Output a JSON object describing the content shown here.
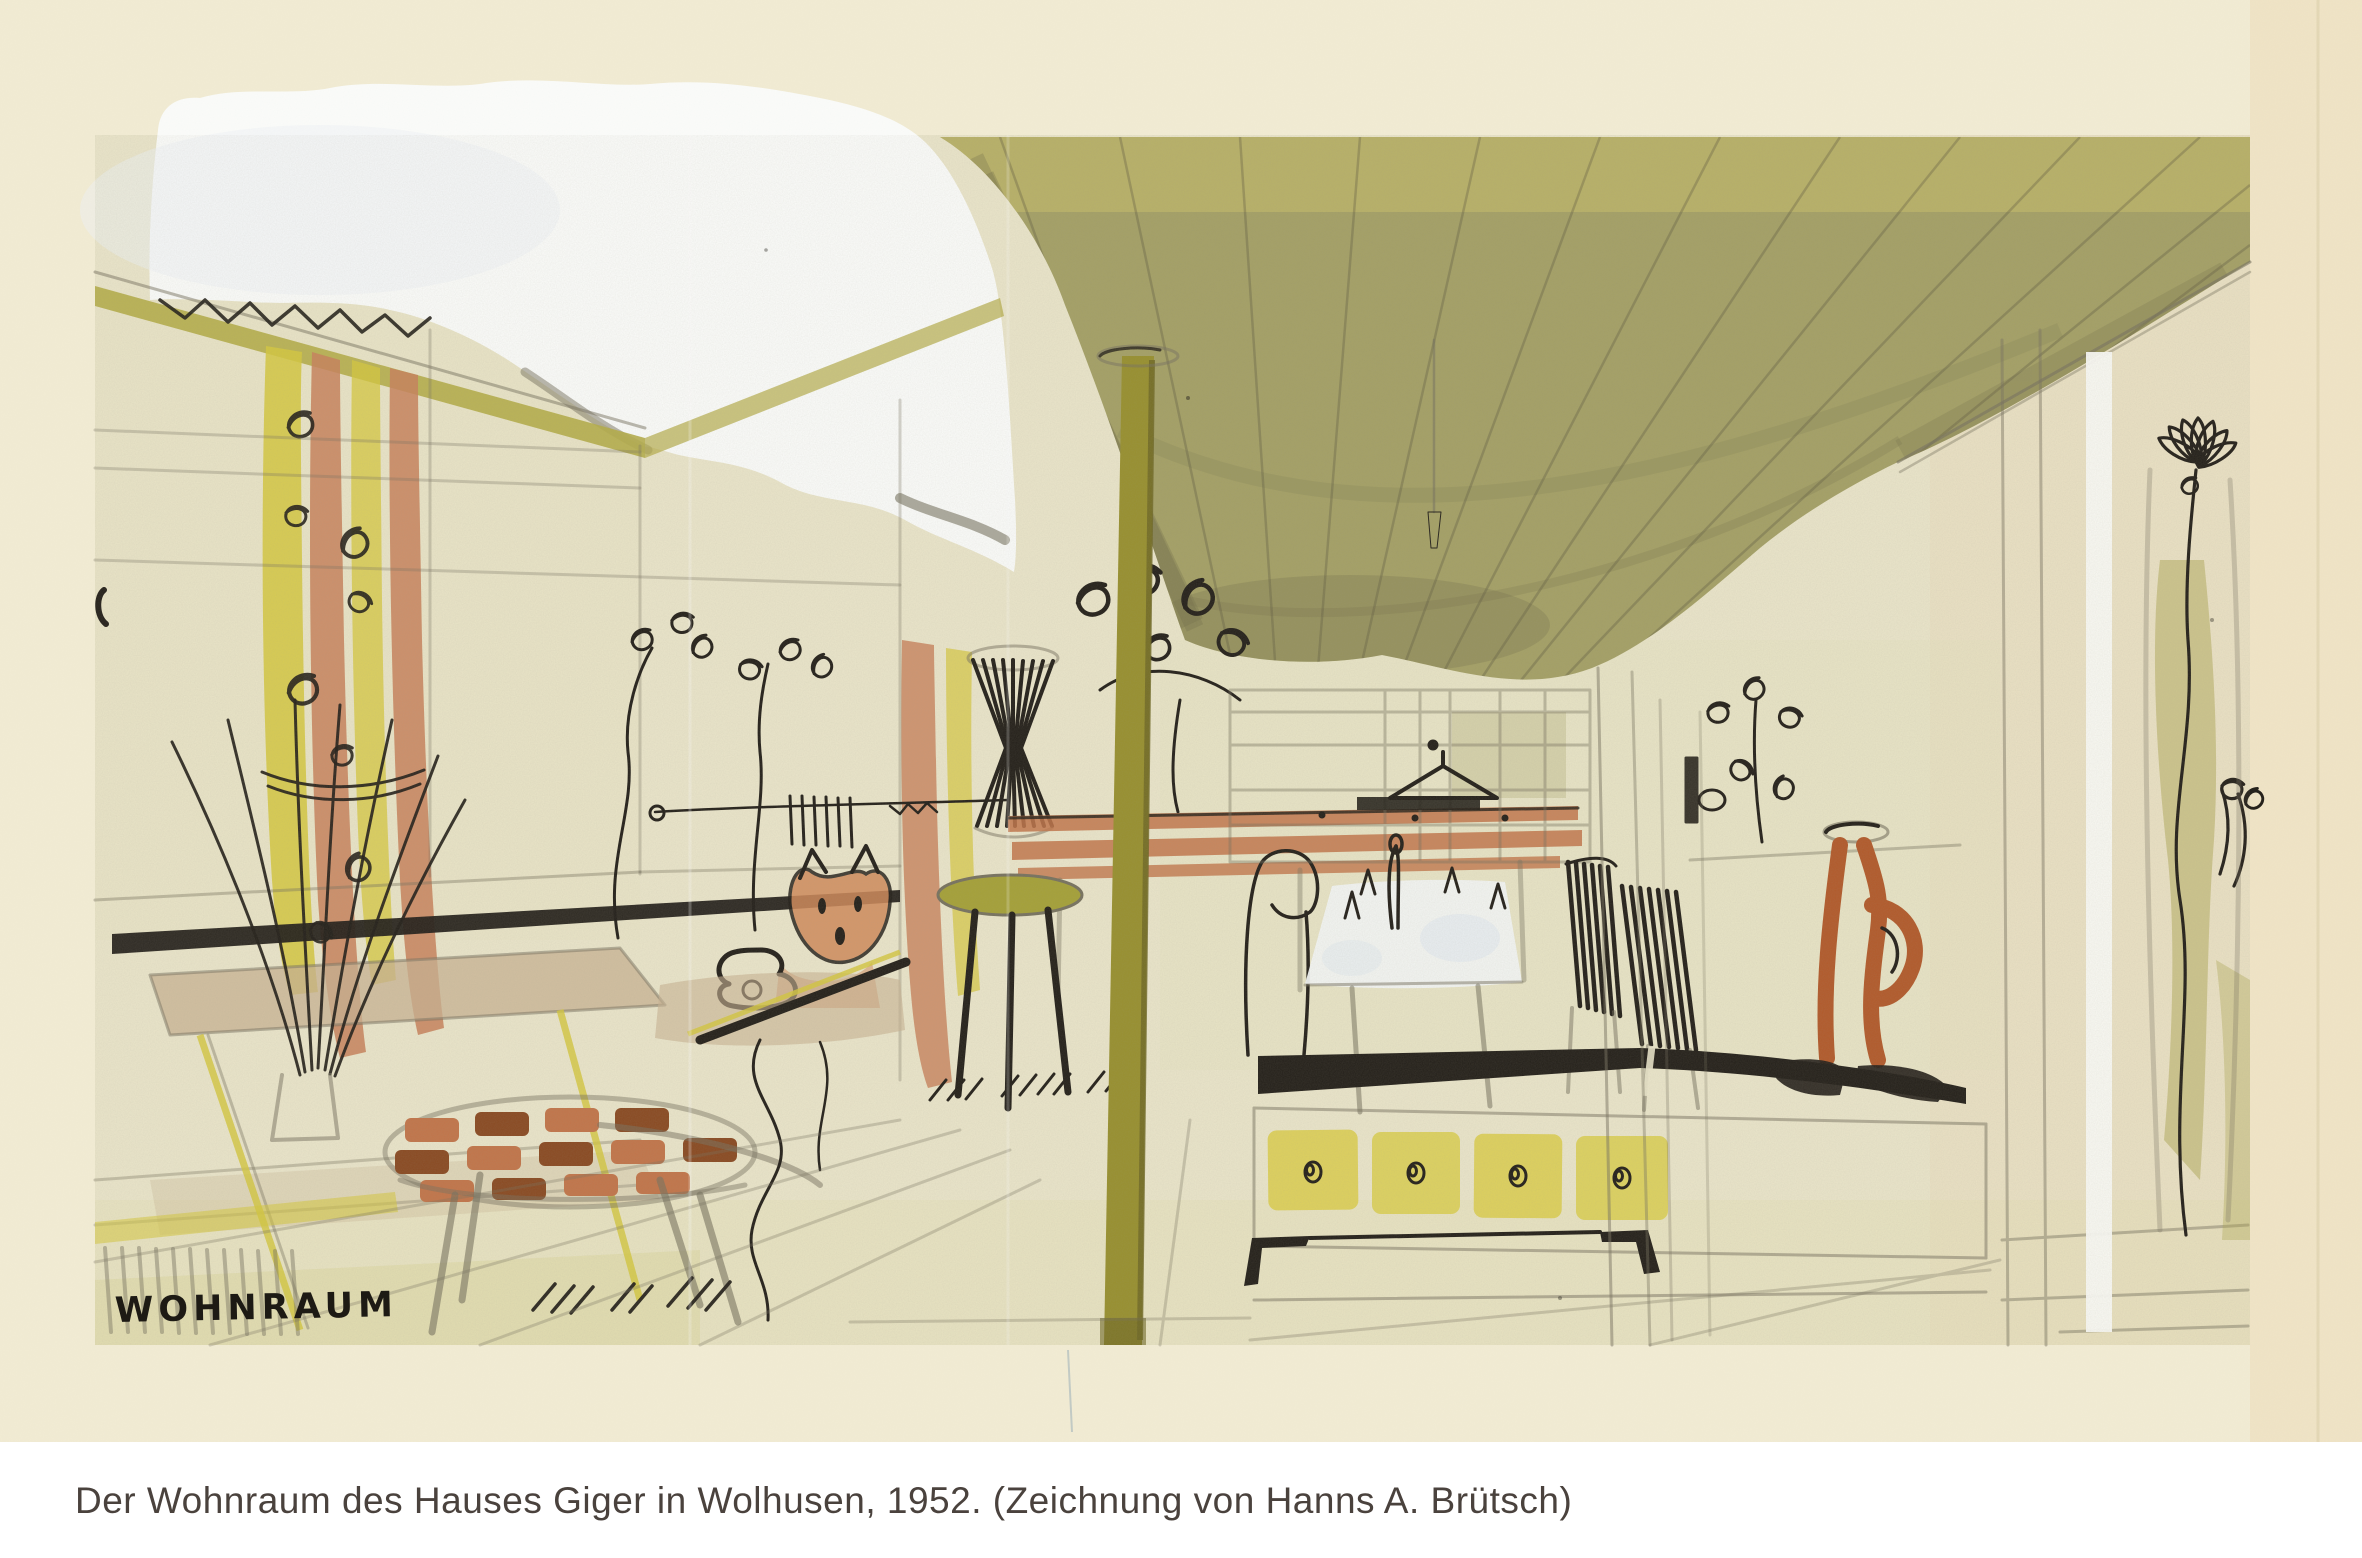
{
  "caption": {
    "text": "Der Wohnraum des Hauses Giger in Wolhusen, 1952. (Zeichnung von Hanns A. Brütsch)"
  },
  "drawing": {
    "room_label": "WOHNRAUM",
    "subject": "living room perspective sketch",
    "media": "pencil, ink and watercolor on cream paper"
  },
  "colors": {
    "paper_margin": "#f2ecd4",
    "paper_sheet": "#eae5ca",
    "paper_right_band": "#ead9b3",
    "caption_bg": "#ffffff",
    "caption_text": "#4a423d",
    "ink": "#24201a",
    "pencil": "#77725f",
    "cloud_white": "#fbfcfa",
    "ceiling_olive": "#a4a066",
    "ceiling_shadow": "#6d6947",
    "ceiling_light": "#c9c06a",
    "beam_olive": "#b5ad49",
    "pole_olive": "#98902f",
    "curtain_yellow": "#d5c83e",
    "curtain_terracotta": "#c8815a",
    "seat_olive": "#a5a138",
    "slat_terracotta": "#c2754a",
    "drawer_yellow": "#dccf55",
    "jug_orange": "#b25a2b",
    "table_white": "#f3f5f4",
    "tan_wash": "#c8b292",
    "floor_green": "#dcd8a0",
    "leaf_olive": "#a8a24a",
    "cat_orange": "#d18a5a"
  }
}
